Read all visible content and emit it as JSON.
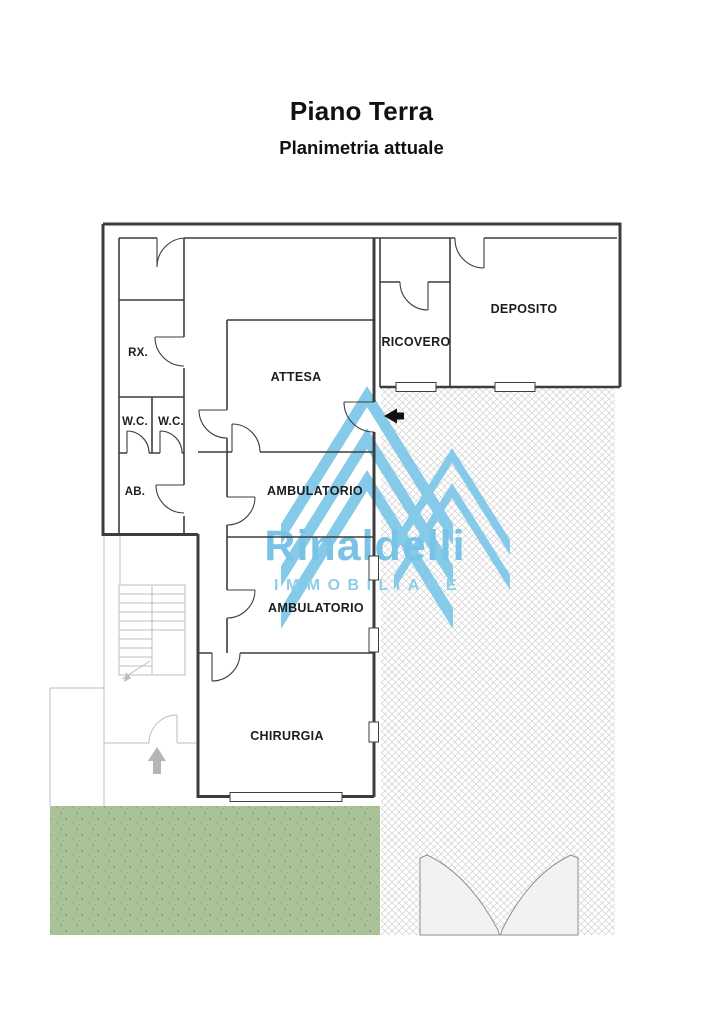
{
  "header": {
    "title": "Piano Terra",
    "subtitle": "Planimetria attuale"
  },
  "plan": {
    "rooms": [
      {
        "id": "rx",
        "label": "RX."
      },
      {
        "id": "wc-left",
        "label": "W.C."
      },
      {
        "id": "wc-right",
        "label": "W.C."
      },
      {
        "id": "ab",
        "label": "AB."
      },
      {
        "id": "attesa",
        "label": "ATTESA"
      },
      {
        "id": "ambulatorio-1",
        "label": "AMBULATORIO"
      },
      {
        "id": "ambulatorio-2",
        "label": "AMBULATORIO"
      },
      {
        "id": "chirurgia",
        "label": "CHIRURGIA"
      },
      {
        "id": "ricovero",
        "label": "RICOVERO"
      },
      {
        "id": "deposito",
        "label": "DEPOSITO"
      }
    ],
    "watermark": {
      "brand": "Rinaldelli",
      "tagline": "IMMOBILIARE",
      "color": "#7cc5e8"
    },
    "colors": {
      "wall": "#3d3d3d",
      "stair_gray": "#bdbdbd",
      "hatch_line": "#c8c8c8",
      "garden_green": "#a9c297",
      "logo_blue": "#85cae9"
    }
  }
}
